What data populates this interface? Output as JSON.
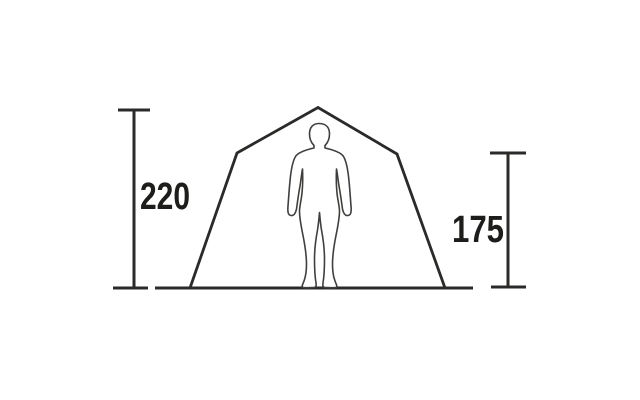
{
  "diagram": {
    "type": "tent-dimension-diagram",
    "subject": "tent front view with human silhouette for scale",
    "background_color": "#ffffff",
    "line_color": "#2b2a29",
    "text_color": "#1d1d1b",
    "figure_outline_color": "#403f3d",
    "dimensions": {
      "left": {
        "value": "220"
      },
      "right": {
        "value": "175"
      }
    },
    "elements": [
      "tent-outline",
      "ground-line",
      "human-figure",
      "height-dimension-left",
      "height-dimension-right"
    ]
  }
}
